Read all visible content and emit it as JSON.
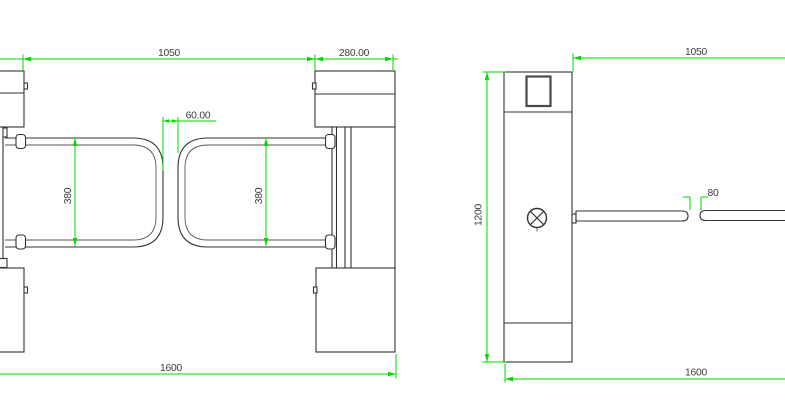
{
  "plan_view": {
    "dim_passage_width": "1050",
    "dim_cabinet_depth": "280.00",
    "dim_arm_gap": "60.00",
    "dim_arm_left_width": "380",
    "dim_arm_right_width": "380",
    "dim_overall_length": "1600"
  },
  "side_view": {
    "dim_arm_length": "1050",
    "dim_cabinet_height": "1200",
    "dim_arm_tip_gap": "80",
    "dim_overall_length": "1600"
  },
  "colors": {
    "dimension_line": "#00d900",
    "drawing_line": "#333333",
    "background": "#ffffff"
  }
}
